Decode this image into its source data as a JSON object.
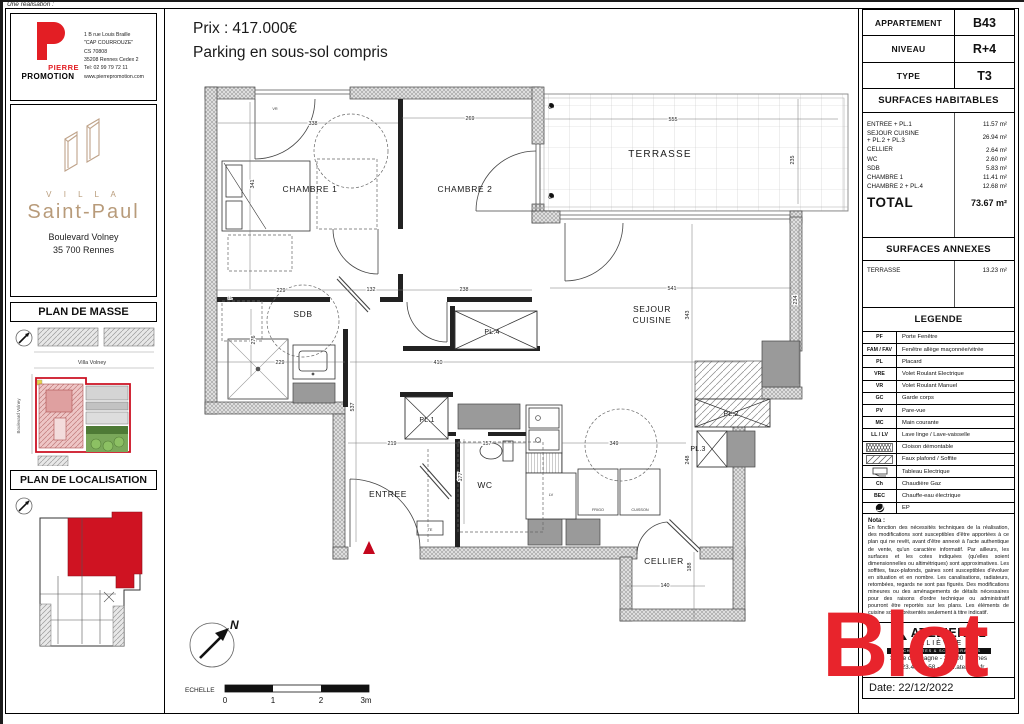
{
  "meta": {
    "realisation": "Une réalisation :"
  },
  "colors": {
    "accent_red": "#e31e24",
    "villa_tan": "#b89b7a",
    "plan_red": "#cf1322",
    "watermark_red": "#e8242c",
    "green": "#6d9c4a"
  },
  "promoter": {
    "line1": "PIERRE",
    "line2": "PROMOTION",
    "address": [
      "1 B rue Louis Braille",
      "\"CAP COURROUZE\"",
      "CS 70808",
      "35208 Rennes Cedex 2",
      "Tel: 02 99 79 72 11",
      "www.pierrepromotion.com"
    ]
  },
  "project": {
    "villa": "V I L L A",
    "name": "Saint-Paul",
    "addr1": "Boulevard Volney",
    "addr2": "35 700 Rennes"
  },
  "masse": {
    "title": "PLAN DE MASSE",
    "street": "Villa Volney",
    "road": "Boulevard Volney"
  },
  "loc": {
    "title": "PLAN DE LOCALISATION"
  },
  "header": {
    "price_label": "Prix :",
    "price": "417.000€",
    "subtitle": "Parking en sous-sol compris"
  },
  "info_table": {
    "rows": [
      {
        "label": "APPARTEMENT",
        "value": "B43"
      },
      {
        "label": "NIVEAU",
        "value": "R+4"
      },
      {
        "label": "TYPE",
        "value": "T3"
      }
    ]
  },
  "surfaces_habitables": {
    "title": "SURFACES HABITABLES",
    "rows": [
      {
        "label": "ENTREE + PL.1",
        "value": "11.57 m²"
      },
      {
        "label": "SEJOUR CUISINE\n+ PL.2 + PL.3",
        "value": "26.94 m²"
      },
      {
        "label": "CELLIER",
        "value": "2.64 m²"
      },
      {
        "label": "WC",
        "value": "2.60 m²"
      },
      {
        "label": "SDB",
        "value": "5.83 m²"
      },
      {
        "label": "CHAMBRE 1",
        "value": "11.41 m²"
      },
      {
        "label": "CHAMBRE 2 + PL.4",
        "value": "12.68 m²"
      }
    ],
    "total_label": "TOTAL",
    "total_value": "73.67 m²"
  },
  "surfaces_annexes": {
    "title": "SURFACES ANNEXES",
    "rows": [
      {
        "label": "TERRASSE",
        "value": "13.23 m²"
      }
    ]
  },
  "legende": {
    "title": "LEGENDE",
    "rows": [
      {
        "code": "PF",
        "label": "Porte Fenêtre"
      },
      {
        "code": "FAM / FAV",
        "label": "Fenêtre allège maçonnée/vitrée"
      },
      {
        "code": "PL",
        "label": "Placard"
      },
      {
        "code": "VRE",
        "label": "Volet Roulant Electrique"
      },
      {
        "code": "VR",
        "label": "Volet Roulant Manuel"
      },
      {
        "code": "GC",
        "label": "Garde corps"
      },
      {
        "code": "PV",
        "label": "Pare-vue"
      },
      {
        "code": "MC",
        "label": "Main courante"
      },
      {
        "code": "LL / LV",
        "label": "Lave linge / Lave-vaisselle"
      },
      {
        "icon": "crosshatch",
        "label": "Cloison démontable"
      },
      {
        "icon": "diagonal",
        "label": "Faux plafond / Soffite"
      },
      {
        "icon": "tableau",
        "label": "Tableau Electrique"
      },
      {
        "code": "Ch",
        "label": "Chaudière Gaz"
      },
      {
        "code": "BEC",
        "label": "Chauffe-eau électrique"
      },
      {
        "icon": "ep",
        "label": "EP"
      }
    ]
  },
  "nota": {
    "title": "Nota :",
    "text": "En fonction des nécessités techniques de la réalisation, des modifications sont susceptibles d'être apportées à ce plan qui ne revêt, avant d'être annexé à l'acte authentique de vente, qu'un caractère informatif. Par ailleurs, les surfaces et les cotes indiquées (qu'elles soient dimensionnelles ou altimétriques) sont approximatives. Les soffites, faux-plafonds, gaines sont susceptibles d'évoluer en situation et en nombre. Les canalisations, radiateurs, retombées, regards ne sont pas figurés. Des modifications mineures ou des aménagements de détails nécessaires pour des raisons d'ordre technique ou administratif pourront être reportés sur les plans. Les éléments de cuisine sont représentés seulement à titre indicatif."
  },
  "architect": {
    "name": "ATELIER L2",
    "sub": "LELIÈVRE",
    "band": "ARCHITECTES & SCENOGRAPHES",
    "addr": "3, rue d'Espagne - 35 200 Rennes",
    "contact": "02.23.45.68.58 - www.atelierl2.fr"
  },
  "date": "Date: 22/12/2022",
  "watermark": "Blot",
  "north": "N",
  "scale": {
    "label": "ECHELLE",
    "ticks": [
      "0",
      "1",
      "2",
      "3m"
    ]
  },
  "floor_plan": {
    "rooms": [
      {
        "name": "CHAMBRE 1",
        "x": 140,
        "y": 108
      },
      {
        "name": "CHAMBRE 2",
        "x": 295,
        "y": 108
      },
      {
        "name": "TERRASSE",
        "x": 490,
        "y": 73,
        "cls": "big"
      },
      {
        "name": "SDB",
        "x": 133,
        "y": 233
      },
      {
        "name": "SEJOUR\nCUISINE",
        "x": 482,
        "y": 228
      },
      {
        "name": "PL.4",
        "x": 322,
        "y": 250,
        "cls": "mid"
      },
      {
        "name": "PL.1",
        "x": 257,
        "y": 338,
        "cls": "mid"
      },
      {
        "name": "PL.2",
        "x": 561,
        "y": 332,
        "cls": "mid"
      },
      {
        "name": "PL.3",
        "x": 528,
        "y": 367,
        "cls": "mid"
      },
      {
        "name": "ENTREE",
        "x": 218,
        "y": 413
      },
      {
        "name": "WC",
        "x": 315,
        "y": 404
      },
      {
        "name": "CELLIER",
        "x": 494,
        "y": 480
      }
    ],
    "dims": [
      {
        "v": "338",
        "x": 143,
        "y": 41
      },
      {
        "v": "269",
        "x": 300,
        "y": 36
      },
      {
        "v": "555",
        "x": 503,
        "y": 37
      },
      {
        "v": "229",
        "x": 111,
        "y": 208
      },
      {
        "v": "132",
        "x": 201,
        "y": 207
      },
      {
        "v": "238",
        "x": 294,
        "y": 207
      },
      {
        "v": "541",
        "x": 502,
        "y": 206
      },
      {
        "v": "229",
        "x": 110,
        "y": 280
      },
      {
        "v": "410",
        "x": 268,
        "y": 280
      },
      {
        "v": "219",
        "x": 222,
        "y": 361
      },
      {
        "v": "157",
        "x": 317,
        "y": 361
      },
      {
        "v": "349",
        "x": 444,
        "y": 361
      },
      {
        "v": "140",
        "x": 495,
        "y": 503
      },
      {
        "v": "341",
        "x": 84,
        "y": 100,
        "r": 1
      },
      {
        "v": "235",
        "x": 624,
        "y": 76,
        "r": 1
      },
      {
        "v": "276",
        "x": 85,
        "y": 256,
        "r": 1
      },
      {
        "v": "537",
        "x": 184,
        "y": 323,
        "r": 1
      },
      {
        "v": "343",
        "x": 519,
        "y": 231,
        "r": 1
      },
      {
        "v": "234",
        "x": 627,
        "y": 216,
        "r": 1
      },
      {
        "v": "177",
        "x": 292,
        "y": 393,
        "r": 1
      },
      {
        "v": "248",
        "x": 519,
        "y": 376,
        "r": 1
      },
      {
        "v": "188",
        "x": 521,
        "y": 483,
        "r": 1
      }
    ],
    "smalls": [
      {
        "t": "VR",
        "x": 105,
        "y": 26
      },
      {
        "t": "LL",
        "x": 60,
        "y": 215
      },
      {
        "t": "TE",
        "x": 260,
        "y": 447
      },
      {
        "t": "LV",
        "x": 381,
        "y": 412
      },
      {
        "t": "FRIGO",
        "x": 428,
        "y": 427
      },
      {
        "t": "CUISSON",
        "x": 470,
        "y": 427
      }
    ]
  }
}
